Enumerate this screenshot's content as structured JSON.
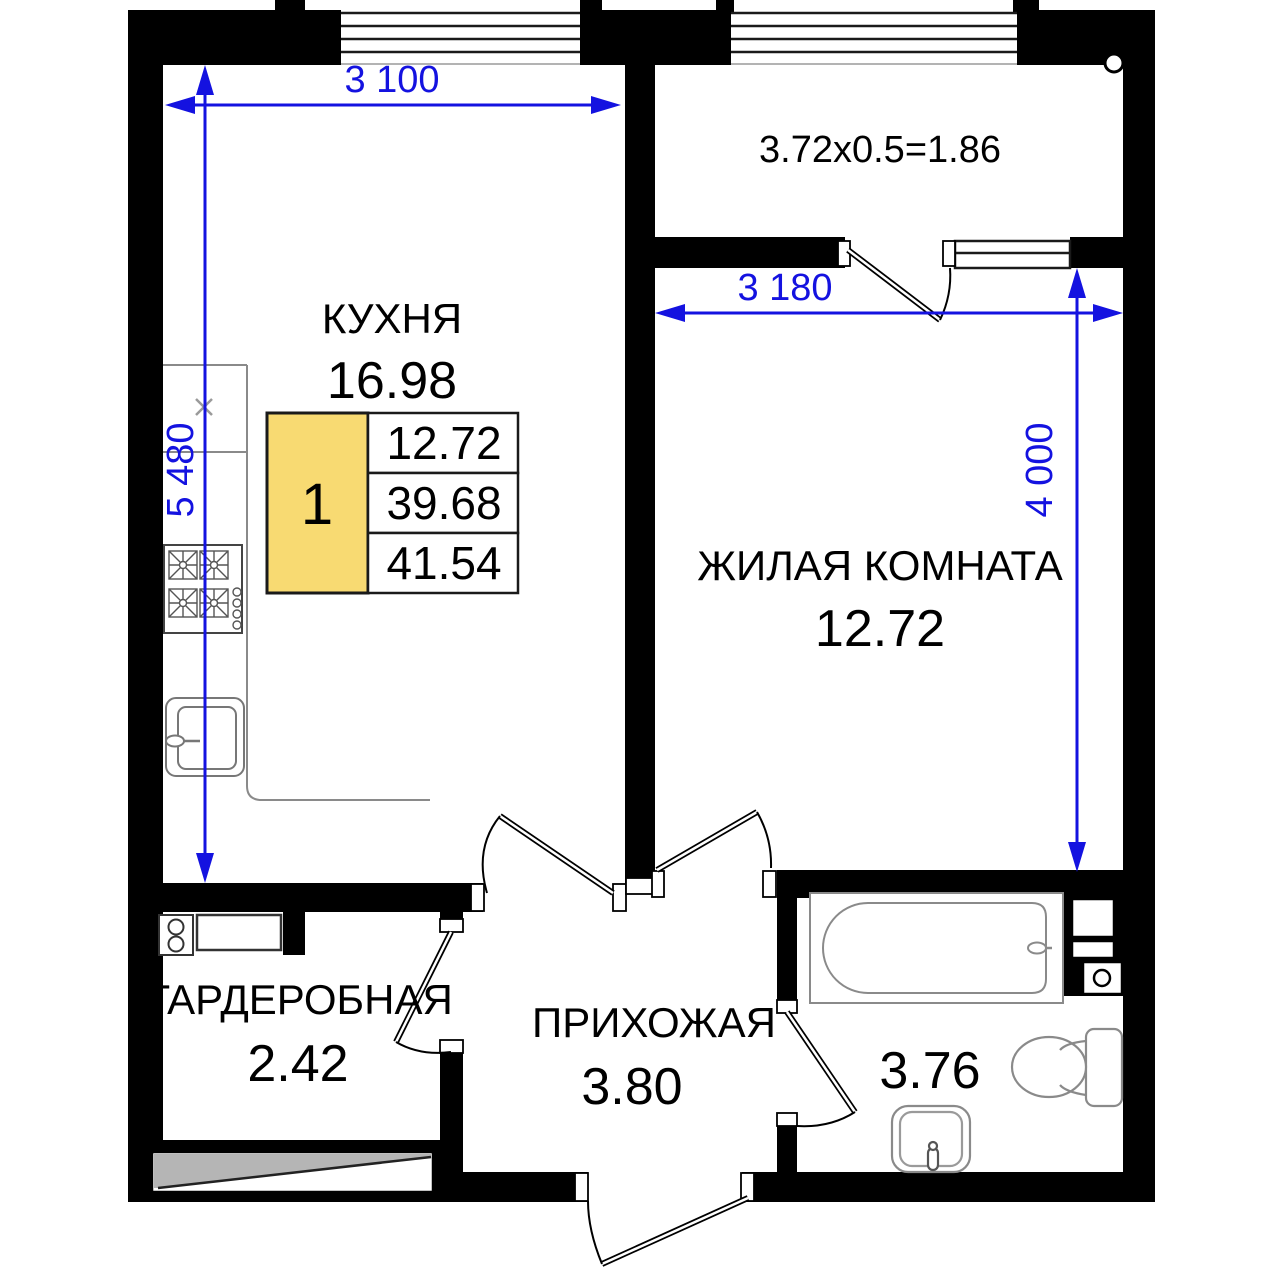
{
  "plan": {
    "rooms": {
      "kitchen": {
        "label": "КУХНЯ",
        "area": "16.98"
      },
      "living": {
        "label": "ЖИЛАЯ КОМНАТА",
        "area": "12.72"
      },
      "wardrobe": {
        "label": "ГАРДЕРОБНАЯ",
        "area": "2.42"
      },
      "hallway": {
        "label": "ПРИХОЖАЯ",
        "area": "3.80"
      },
      "bathroom": {
        "area": "3.76"
      }
    },
    "balcony": {
      "formula": "3.72x0.5=1.86"
    },
    "dims": {
      "top_width": "3 100",
      "left_height": "5 480",
      "living_width": "3 180",
      "living_height": "4 000"
    },
    "legend": {
      "unit_number": "1",
      "rows": [
        "12.72",
        "39.68",
        "41.54"
      ],
      "highlight_color": "#F8DA72"
    },
    "colors": {
      "walls": "#000000",
      "dimensions": "#1412E0",
      "fixtures": "#8a8a8a"
    }
  }
}
